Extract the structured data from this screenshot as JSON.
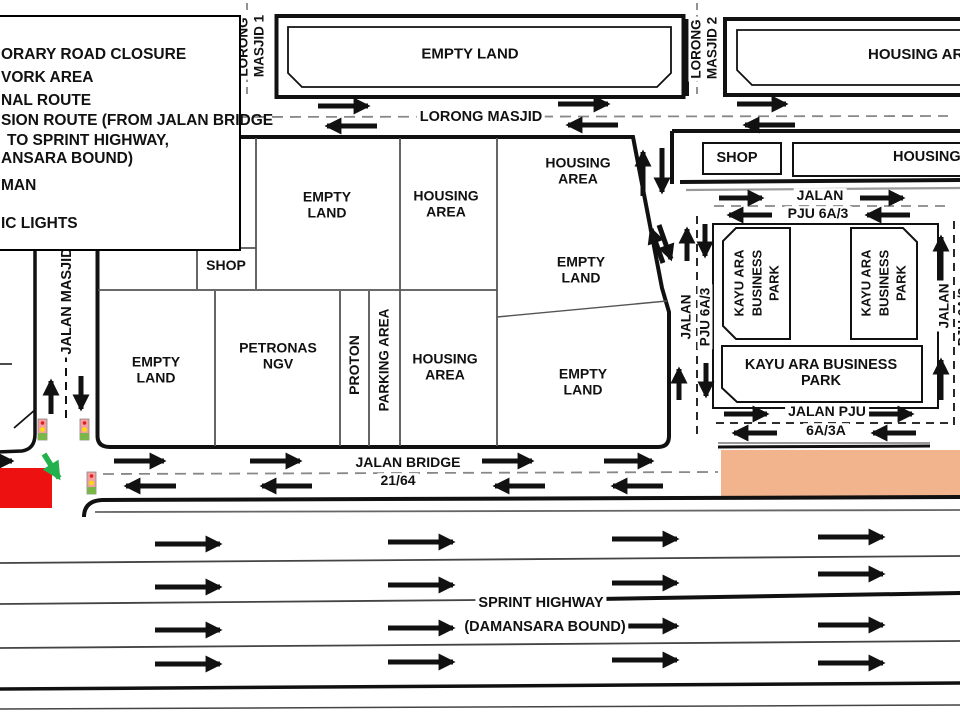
{
  "legend": {
    "lines": [
      "ORARY ROAD CLOSURE",
      "VORK AREA",
      "NAL ROUTE",
      "SION ROUTE (FROM JALAN BRIDGE",
      "TO SPRINT HIGHWAY,",
      "ANSARA BOUND)",
      "MAN",
      "IC LIGHTS"
    ]
  },
  "top": {
    "empty_land": "EMPTY LAND",
    "housing_area": "HOUSING AREA",
    "lorong_masjid_1a": "LORONG",
    "lorong_masjid_1b": "MASJID 1",
    "lorong_masjid_2a": "LORONG",
    "lorong_masjid_2b": "MASJID 2",
    "lorong_masjid": "LORONG MASJID"
  },
  "block": {
    "shop": "SHOP",
    "empty_land_top": "EMPTY LAND",
    "housing_top": "HOUSING AREA",
    "housing_ne": "HOUSING AREA",
    "empty_mid": "EMPTY LAND",
    "empty_bottom": "EMPTY LAND",
    "empty_sw": "EMPTY LAND",
    "petronas": "PETRONAS NGV",
    "proton": "PROTON",
    "parking": "PARKING AREA",
    "housing_s": "HOUSING AREA",
    "jalan_masjid": "JALAN MASJID"
  },
  "east": {
    "shop": "SHOP",
    "housing": "HOUSING AREA",
    "jalan_top_1": "JALAN",
    "jalan_top_2": "PJU 6A/3",
    "jalan_left_1": "JALAN",
    "jalan_left_2": "PJU 6A/3",
    "jalan_right_1": "JALAN",
    "jalan_right_2": "PJU 6A/3",
    "kayu_v": "KAYU ARA BUSINESS PARK",
    "kayu_h": "KAYU ARA BUSINESS PARK",
    "jalan_3a_1": "JALAN PJU",
    "jalan_3a_2": "6A/3A"
  },
  "south": {
    "jalan_bridge_1": "JALAN BRIDGE",
    "jalan_bridge_2": "21/64",
    "highway_1": "SPRINT HIGHWAY",
    "highway_2": "(DAMANSARA BOUND)"
  },
  "colors": {
    "closure_red": "#ee1111",
    "diversion_green": "#22b14c",
    "work_area_tan": "#f2b48d",
    "arrow_black": "#111111"
  }
}
